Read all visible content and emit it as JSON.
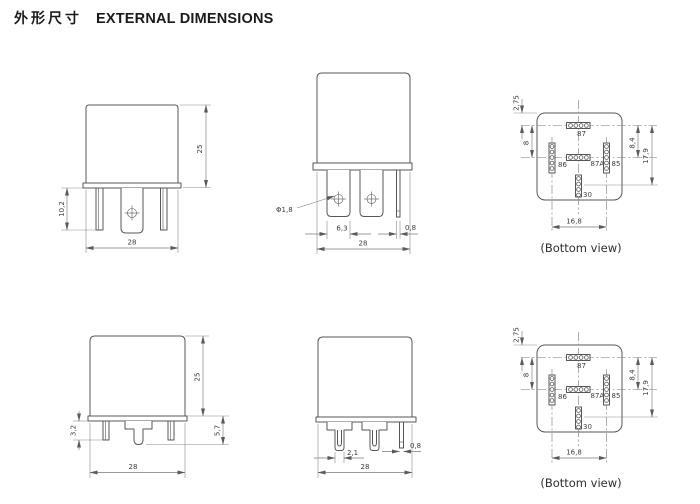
{
  "page": {
    "title_cn": "外形尺寸",
    "title_en": "EXTERNAL DIMENSIONS"
  },
  "colors": {
    "background": "#ffffff",
    "object_line": "#575757",
    "dim_line": "#7a7a7a",
    "text": "#3c3c3c"
  },
  "views": {
    "front_qc": {
      "dims": {
        "body_height": "25",
        "pin_length": "10,2",
        "body_width": "28"
      }
    },
    "side_qc": {
      "dims": {
        "hole_dia": "Φ1,8",
        "terminal_width": "6,3",
        "thin_pin_width": "0,8",
        "body_width": "28"
      }
    },
    "bottom_qc": {
      "caption": "(Bottom view)",
      "pins": {
        "p87": "87",
        "p86": "86",
        "p87a": "87A",
        "p85": "85",
        "p30": "30"
      },
      "dims": {
        "edge_to_row1": "2,75",
        "row1_to_row2_left": "8",
        "row1_to_row2_right": "8,4",
        "row1_to_pin30": "17,9",
        "pin_row_span": "16,8"
      }
    },
    "front_pcb": {
      "dims": {
        "body_height": "25",
        "pin_protrusion": "3,2",
        "base_to_pin_tip": "5,7",
        "body_width": "28"
      }
    },
    "side_pcb": {
      "dims": {
        "pin_tip_width": "2,1",
        "thin_pin_width": "0,8",
        "body_width": "28"
      }
    },
    "bottom_pcb": {
      "caption": "(Bottom view)",
      "pins": {
        "p87": "87",
        "p86": "86",
        "p87a": "87A",
        "p85": "85",
        "p30": "30"
      },
      "dims": {
        "edge_to_row1": "2,75",
        "row1_to_row2_left": "8",
        "row1_to_row2_right": "8,4",
        "row1_to_pin30": "17,9",
        "pin_row_span": "16,8"
      }
    }
  }
}
